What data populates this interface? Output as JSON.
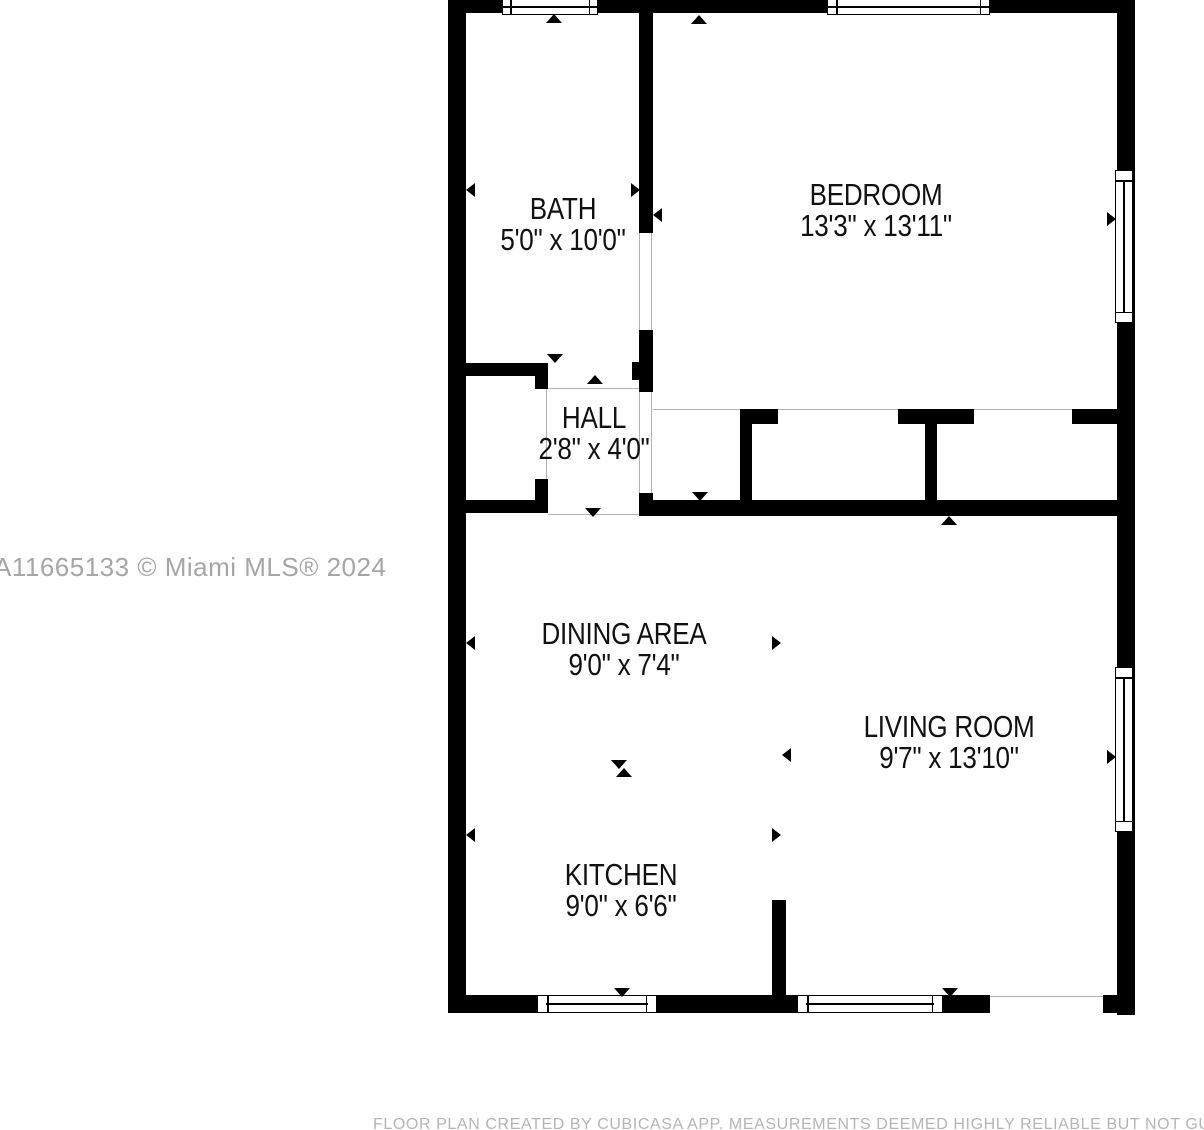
{
  "floor_plan": {
    "rooms": [
      {
        "name": "BATH",
        "dimensions": "5'0\" x 10'0\""
      },
      {
        "name": "BEDROOM",
        "dimensions": "13'3\" x 13'11\""
      },
      {
        "name": "HALL",
        "dimensions": "2'8\" x 4'0\""
      },
      {
        "name": "DINING AREA",
        "dimensions": "9'0\" x 7'4\""
      },
      {
        "name": "LIVING ROOM",
        "dimensions": "9'7\" x 13'10\""
      },
      {
        "name": "KITCHEN",
        "dimensions": "9'0\" x 6'6\""
      }
    ],
    "watermark": "A11665133 © Miami MLS® 2024",
    "disclaimer": "FLOOR PLAN CREATED BY CUBICASA APP. MEASUREMENTS DEEMED HIGHLY RELIABLE BUT NOT GUARANTEED",
    "colors": {
      "wall": "#000000",
      "background": "#ffffff",
      "watermark_text": "#a6a6a6",
      "disclaimer_text": "#b5b5b5",
      "opening_line": "#b3b3b3"
    }
  }
}
